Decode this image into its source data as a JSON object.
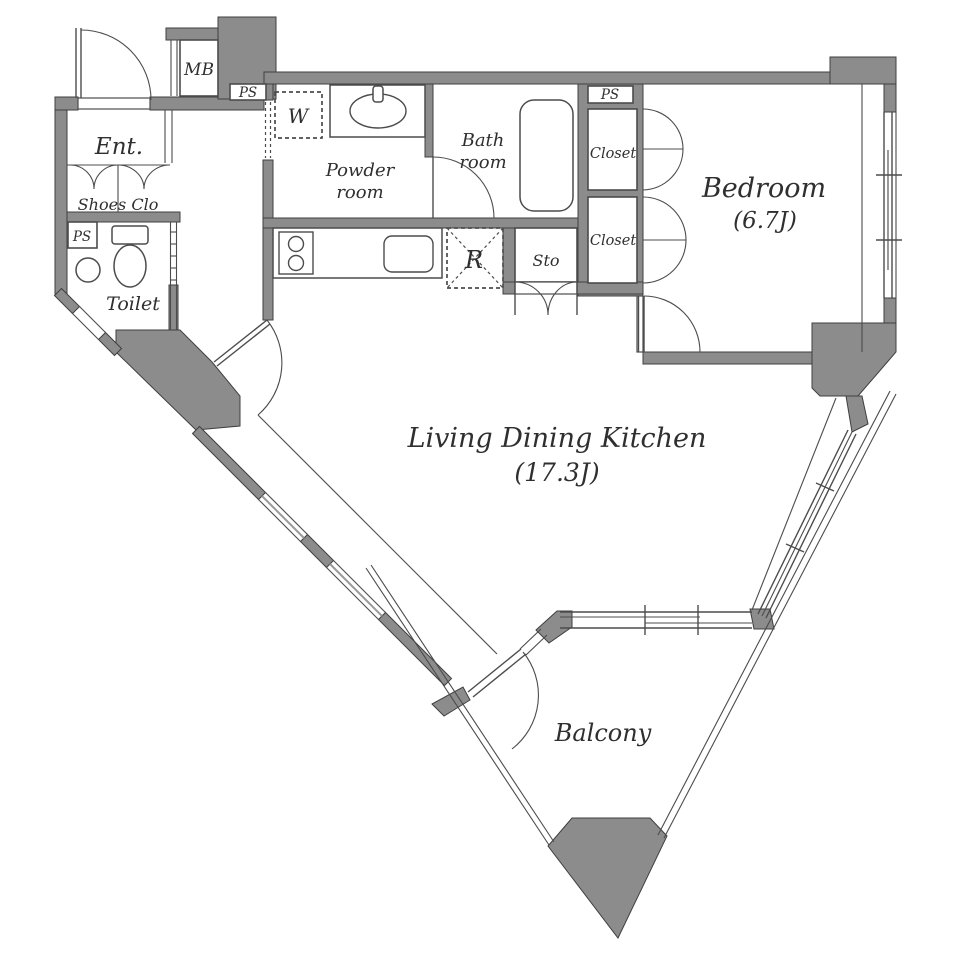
{
  "plan": {
    "rooms": {
      "entrance": "Ent.",
      "shoes_closet": "Shoes Clo",
      "toilet": "Toilet",
      "powder_room_line1": "Powder",
      "powder_room_line2": "room",
      "bathroom_line1": "Bath",
      "bathroom_line2": "room",
      "storage": "Sto",
      "closet_upper": "Closet",
      "closet_lower": "Closet",
      "bedroom_name": "Bedroom",
      "bedroom_size": "(6.7J)",
      "ldk_name": "Living Dining Kitchen",
      "ldk_size": "(17.3J)",
      "balcony": "Balcony"
    },
    "utilities": {
      "meter_box": "MB",
      "pipe_space_top": "PS",
      "pipe_space_bedroom": "PS",
      "pipe_space_toilet": "PS",
      "washer_space": "W",
      "refrigerator_space": "R"
    },
    "colors": {
      "wall": "#8c8c8c",
      "outline": "#3f3f3f",
      "line": "#4c4c4c",
      "text": "#2f2f2f",
      "floor": "#ffffff"
    }
  }
}
